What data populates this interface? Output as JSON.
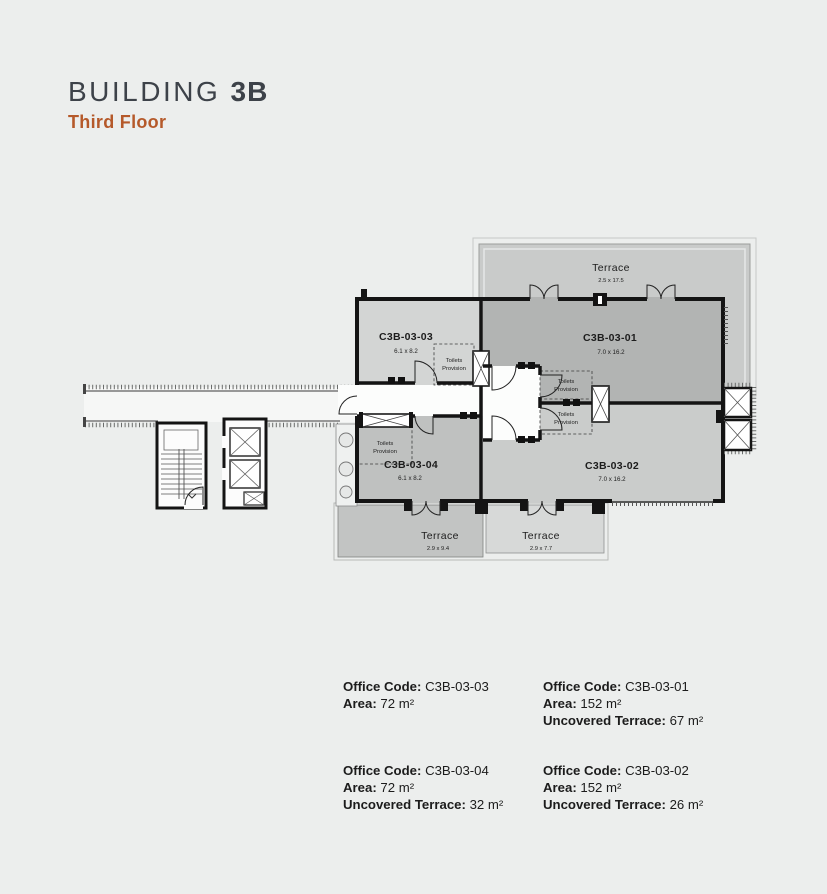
{
  "header": {
    "building_word": "BUILDING",
    "building_number": "3B",
    "floor_label": "Third Floor"
  },
  "plan": {
    "colors": {
      "room03": "#d3d5d4",
      "room01": "#b2b4b3",
      "room04": "#bfc1c0",
      "room02": "#cacccb",
      "terrace_top": "#c9cbca",
      "terrace_a": "#c2c4c3",
      "terrace_b": "#d7d9d8",
      "wall": "#141414",
      "accent": "#b5592a",
      "title": "#3d4249",
      "background": "#eceeed"
    },
    "rooms": [
      {
        "id": "C3B-03-03",
        "dims": "6.1 x 8.2"
      },
      {
        "id": "C3B-03-01",
        "dims": "7.0 x 16.2"
      },
      {
        "id": "C3B-03-04",
        "dims": "6.1 x 8.2"
      },
      {
        "id": "C3B-03-02",
        "dims": "7.0 x 16.2"
      }
    ],
    "terraces": [
      {
        "label": "Terrace",
        "dims": "2.5 x 17.5"
      },
      {
        "label": "Terrace",
        "dims": "2.9 x 9.4"
      },
      {
        "label": "Terrace",
        "dims": "2.9 x 7.7"
      }
    ],
    "toilets": {
      "line1": "Toilets",
      "line2": "Provision"
    }
  },
  "legend_labels": {
    "office_code": "Office Code:",
    "area": "Area:",
    "uncovered_terrace": "Uncovered Terrace:"
  },
  "units": [
    {
      "code": "C3B-03-03",
      "area": "72 m²"
    },
    {
      "code": "C3B-03-01",
      "area": "152 m²",
      "uncovered_terrace": "67 m²"
    },
    {
      "code": "C3B-03-04",
      "area": "72 m²",
      "uncovered_terrace": "32 m²"
    },
    {
      "code": "C3B-03-02",
      "area": "152 m²",
      "uncovered_terrace": "26 m²"
    }
  ]
}
